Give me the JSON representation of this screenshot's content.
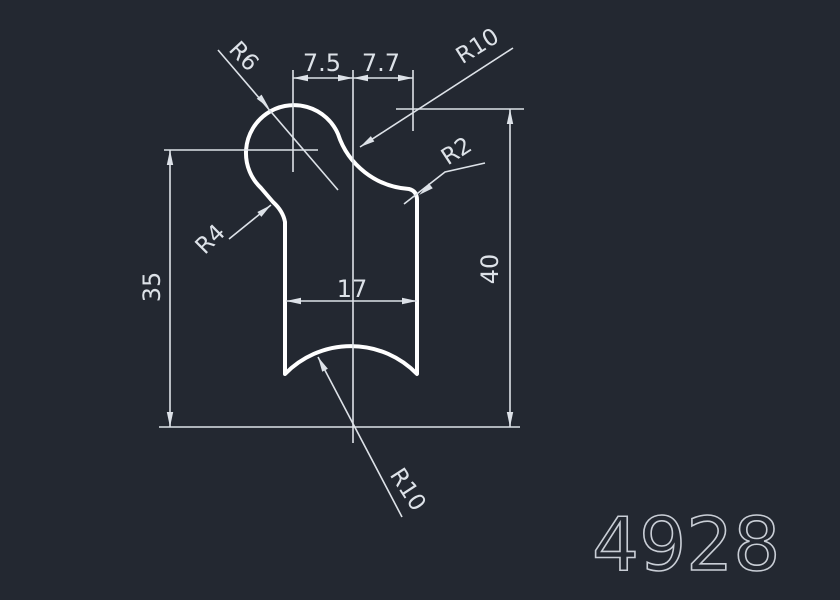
{
  "drawing": {
    "part_number": "4928",
    "dimensions": {
      "top_left_width": "7.5",
      "top_right_width": "7.7",
      "inner_width": "17",
      "left_height": "35",
      "right_height": "40"
    },
    "radius_callouts": {
      "top_left": "R6",
      "top_right": "R10",
      "right_side": "R2",
      "left_side": "R4",
      "bottom": "R10"
    },
    "colors": {
      "background": "#232831",
      "outline": "#ffffff",
      "dimension": "#dde2e8",
      "part_number": "#c9ced6"
    }
  }
}
